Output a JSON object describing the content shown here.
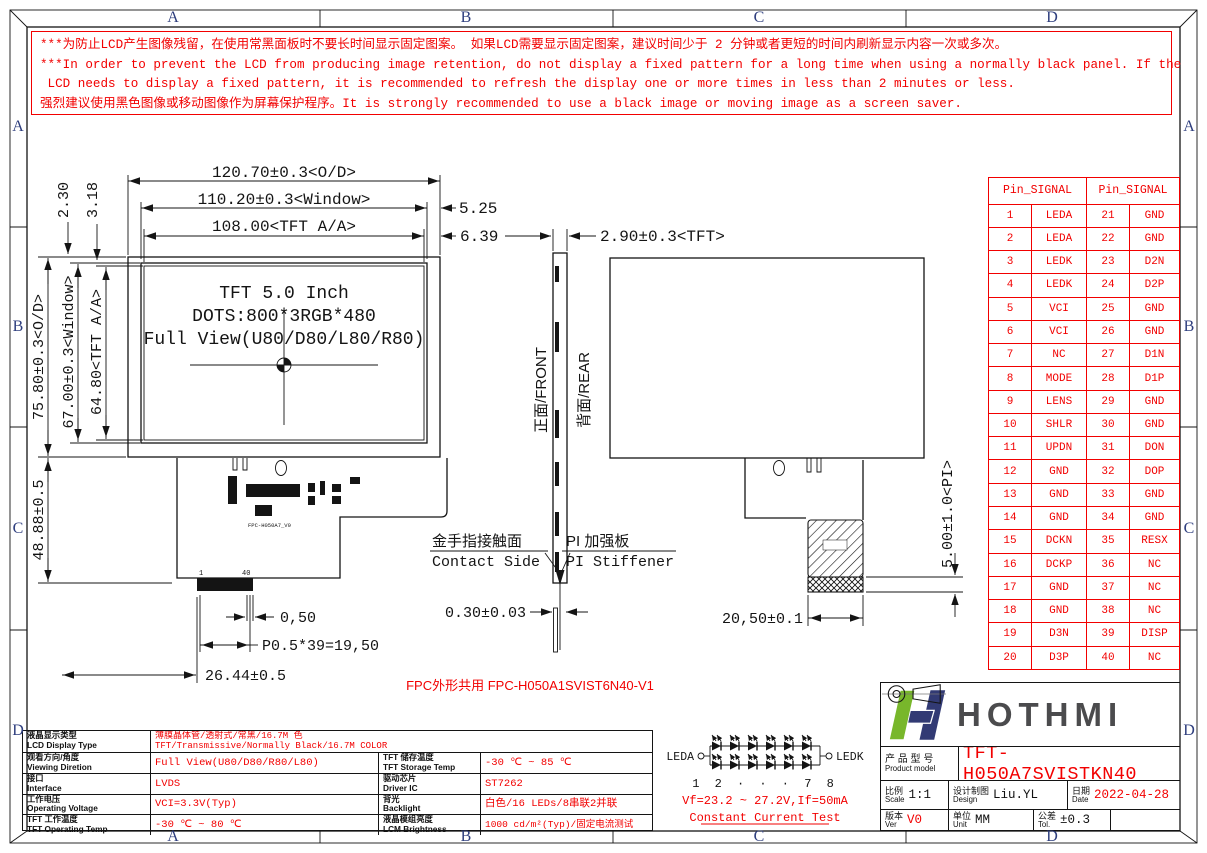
{
  "sheet": {
    "zones": [
      "A",
      "B",
      "C",
      "D"
    ]
  },
  "colors": {
    "red": "#f20000",
    "zone_letter": "#2e3e7e",
    "logo_green": "#78b72b",
    "logo_navy": "#323a74",
    "logo_text": "#4b4b4d"
  },
  "warning": {
    "lines": [
      "***为防止LCD产生图像残留，在使用常黑面板时不要长时间显示固定图案。 如果LCD需要显示固定图案，建议时间少于 2 分钟或者更短的时间内刷新显示内容一次或多次。",
      "***In order to prevent the LCD from producing image retention, do not display a fixed pattern for a long time when using a normally black panel. If the",
      " LCD needs to display a fixed pattern, it is recommended to refresh the display one or more times in less than 2 minutes or less.",
      "强烈建议使用黑色图像或移动图像作为屏幕保护程序。It is strongly recommended to use a black image or moving image as a screen saver."
    ]
  },
  "panel": {
    "line1": "TFT 5.0 Inch",
    "line2": "DOTS:800*3RGB*480",
    "line3": "Full View(U80/D80/L80/R80)"
  },
  "dims": {
    "od_h": "120.70±0.3<O/D>",
    "window_h": "110.20±0.3<Window>",
    "aa_h": "108.00<TFT A/A>",
    "window_right": "5.25",
    "aa_right": "6.39",
    "top_offset_window": "2.30",
    "top_offset_aa": "3.18",
    "od_v": "75.80±0.3<O/D>",
    "window_v": "67.00±0.3<Window>",
    "aa_v": "64.80<TFT A/A>",
    "fpc_drop": "48.88±0.5",
    "pin_pitch": "0,50",
    "pitch_total": "P0.5*39=19,50",
    "fpc_width": "26.44±0.5",
    "tft_thickness": "2.90±0.3<TFT>",
    "fpc_thickness": "0.30±0.03",
    "stiffener_width": "20,50±0.1",
    "pi_height": "5.00±1.0<PI>"
  },
  "side_view": {
    "front_label": "正面/FRONT",
    "rear_label": "背面/REAR"
  },
  "contact": {
    "cn": "金手指接触面",
    "en": "Contact Side"
  },
  "stiffener": {
    "cn": "PI 加强板",
    "en": "PI Stiffener"
  },
  "fpc_note": "FPC外形共用 FPC-H050A1SVIST6N40-V1",
  "connector": {
    "pin_first": "1",
    "pin_last": "40",
    "fpc_label": "FPC-H050A7_V0"
  },
  "pin_table": {
    "header": "Pin_SIGNAL",
    "rows": [
      [
        "1",
        "LEDA",
        "21",
        "GND"
      ],
      [
        "2",
        "LEDA",
        "22",
        "GND"
      ],
      [
        "3",
        "LEDK",
        "23",
        "D2N"
      ],
      [
        "4",
        "LEDK",
        "24",
        "D2P"
      ],
      [
        "5",
        "VCI",
        "25",
        "GND"
      ],
      [
        "6",
        "VCI",
        "26",
        "GND"
      ],
      [
        "7",
        "NC",
        "27",
        "D1N"
      ],
      [
        "8",
        "MODE",
        "28",
        "D1P"
      ],
      [
        "9",
        "LENS",
        "29",
        "GND"
      ],
      [
        "10",
        "SHLR",
        "30",
        "GND"
      ],
      [
        "11",
        "UPDN",
        "31",
        "DON"
      ],
      [
        "12",
        "GND",
        "32",
        "DOP"
      ],
      [
        "13",
        "GND",
        "33",
        "GND"
      ],
      [
        "14",
        "GND",
        "34",
        "GND"
      ],
      [
        "15",
        "DCKN",
        "35",
        "RESX"
      ],
      [
        "16",
        "DCKP",
        "36",
        "NC"
      ],
      [
        "17",
        "GND",
        "37",
        "NC"
      ],
      [
        "18",
        "GND",
        "38",
        "NC"
      ],
      [
        "19",
        "D3N",
        "39",
        "DISP"
      ],
      [
        "20",
        "D3P",
        "40",
        "NC"
      ]
    ]
  },
  "specs": {
    "rows": [
      {
        "label_cn": "液晶显示类型",
        "label_en": "LCD Display Type",
        "value_line1": "薄膜晶体管/透射式/常黑/16.7M 色",
        "value_line2": "TFT/Transmissive/Normally Black/16.7M COLOR"
      },
      {
        "label_cn": "观看方向/角度",
        "label_en": "Viewing Diretion",
        "value": "Full View(U80/D80/R80/L80)",
        "label2_cn": "TFT 储存温度",
        "label2_en": "TFT Storage Temp",
        "value2": "-30 ℃ ~ 85 ℃"
      },
      {
        "label_cn": "接口",
        "label_en": "Interface",
        "value": "LVDS",
        "label2_cn": "驱动芯片",
        "label2_en": "Driver IC",
        "value2": "ST7262"
      },
      {
        "label_cn": "工作电压",
        "label_en": "Operating Voltage",
        "value": "VCI=3.3V(Typ)",
        "label2_cn": "背光",
        "label2_en": "Backlight",
        "value2": "白色/16 LEDs/8串联2并联"
      },
      {
        "label_cn": "TFT 工作温度",
        "label_en": "TFT Operating Temp",
        "value": "-30 ℃ ~ 80 ℃",
        "label2_cn": "液晶模组亮度",
        "label2_en": "LCM Brightness",
        "value2": "1000 cd/m²(Typ)/固定电流测试"
      }
    ]
  },
  "led_circuit": {
    "anode": "LEDA",
    "cathode": "LEDK",
    "index_label": "1 2 · · · 7 8",
    "spec": "Vf=23.2 ~ 27.2V,If=50mA",
    "test": "Constant Current Test"
  },
  "title_block": {
    "brand": "HOTHMI",
    "model_label_cn": "产 品 型 号",
    "model_label_en": "Product model",
    "model": "TFT-H050A7SVISTKN40",
    "scale_label_cn": "比例",
    "scale_label_en": "Scale",
    "scale": "1:1",
    "design_label_cn": "设计制图",
    "design_label_en": "Design",
    "designer": "Liu.YL",
    "date_label_cn": "日期",
    "date_label_en": "Date",
    "date": "2022-04-28",
    "ver_label_cn": "版本",
    "ver_label_en": "Ver",
    "version": "V0",
    "unit_label_cn": "单位",
    "unit_label_en": "Unit",
    "unit": "MM",
    "tol_label_cn": "公差",
    "tol_label_en": "Tol.",
    "tolerance": "±0.3"
  }
}
